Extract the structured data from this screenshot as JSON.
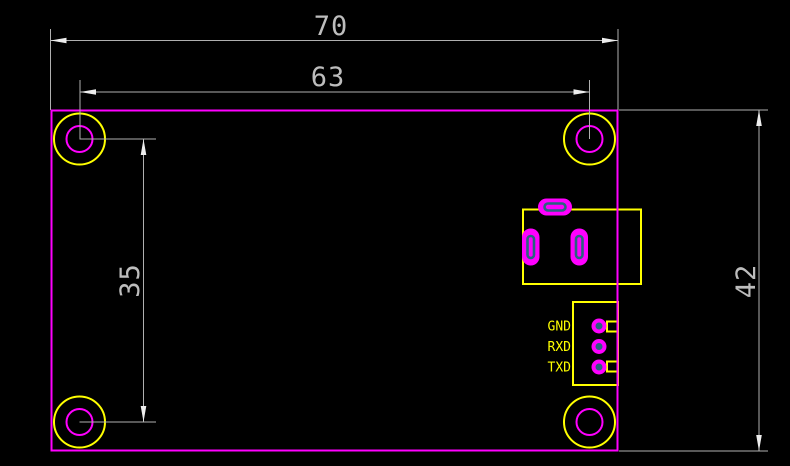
{
  "drawing": {
    "type": "pcb-dimension-drawing",
    "dims": {
      "overall_width": "70",
      "hole_span_width": "63",
      "hole_span_height": "35",
      "overall_height": "42"
    },
    "pins": {
      "labels": [
        "GND",
        "RXD",
        "TXD"
      ]
    },
    "colors": {
      "background": "#000000",
      "outline": "#FF00FF",
      "silk": "#FFFF00",
      "dim_line": "#B0B0B0",
      "dim_text": "#BDBDBD",
      "arrow": "#EDEDED",
      "drill": "#28647F"
    }
  }
}
